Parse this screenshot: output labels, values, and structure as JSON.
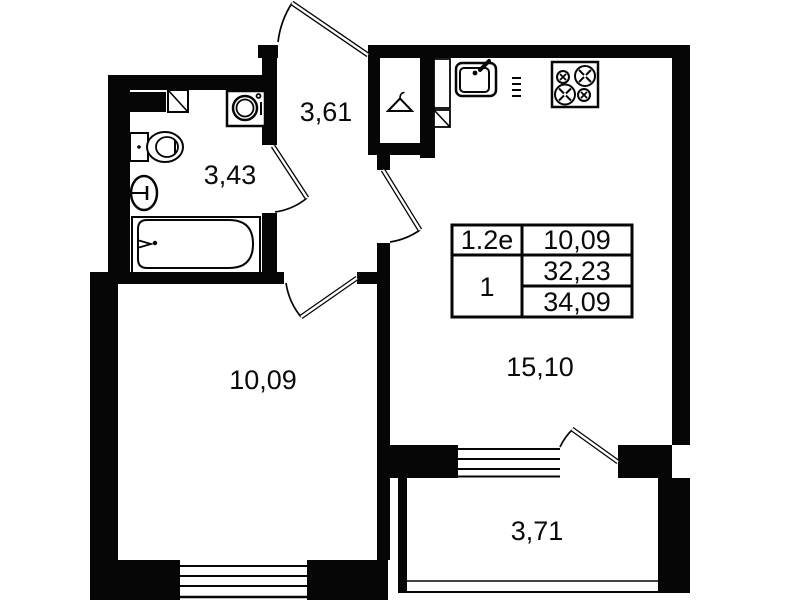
{
  "plan": {
    "title": "apartment-floor-plan",
    "colors": {
      "ink": "#060606",
      "paper": "#ffffff"
    },
    "rooms": [
      {
        "id": "hallway",
        "area": "3,61"
      },
      {
        "id": "bathroom",
        "area": "3,43"
      },
      {
        "id": "bedroom",
        "area": "10,09"
      },
      {
        "id": "kitchen-living",
        "area": "15,10"
      },
      {
        "id": "balcony",
        "area": "3,71"
      }
    ],
    "info_table": {
      "unit_code": "1.2е",
      "room_count": "1",
      "living_area": "10,09",
      "area_without_balcony": "32,23",
      "total_area": "34,09"
    },
    "fixtures": {
      "bathroom": [
        "cabinet",
        "shelf",
        "washing-machine",
        "toilet",
        "wash-basin",
        "bathtub"
      ],
      "hallway": [
        "wardrobe-hanger",
        "duct-shaft"
      ],
      "kitchen": [
        "kitchen-sink",
        "stove"
      ]
    }
  }
}
